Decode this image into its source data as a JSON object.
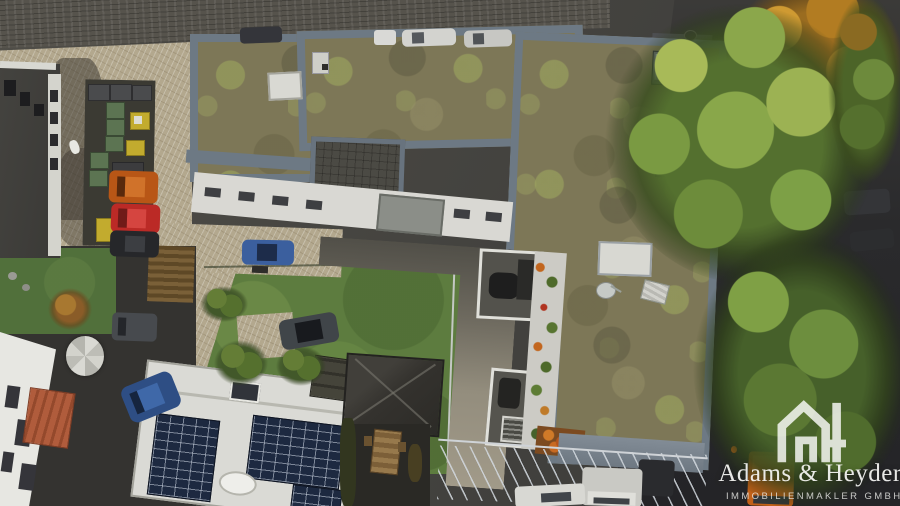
{
  "watermark": {
    "brand": "Adams & Heyder",
    "subtitle": "IMMOBILIENMAKLER GMBH",
    "icon": "ah-house-logo-icon",
    "text_color": "#f4f4f2"
  },
  "palette": {
    "roof_moss": "#7d7757",
    "roof_parapet": "#6d7984",
    "paver": "#b3a88e",
    "street_asphalt": "#4a4945",
    "asphalt_dark": "#2b2b2d",
    "lawn": "#5d7c3f",
    "tree_green": "#6d8a3c",
    "tree_autumn": "#b97f26",
    "solar_panel": "#1d2940",
    "truck_orange": "#c9641c",
    "car_orange": "#b85616",
    "car_red": "#bb2a26",
    "car_blue": "#3b5f9e"
  }
}
